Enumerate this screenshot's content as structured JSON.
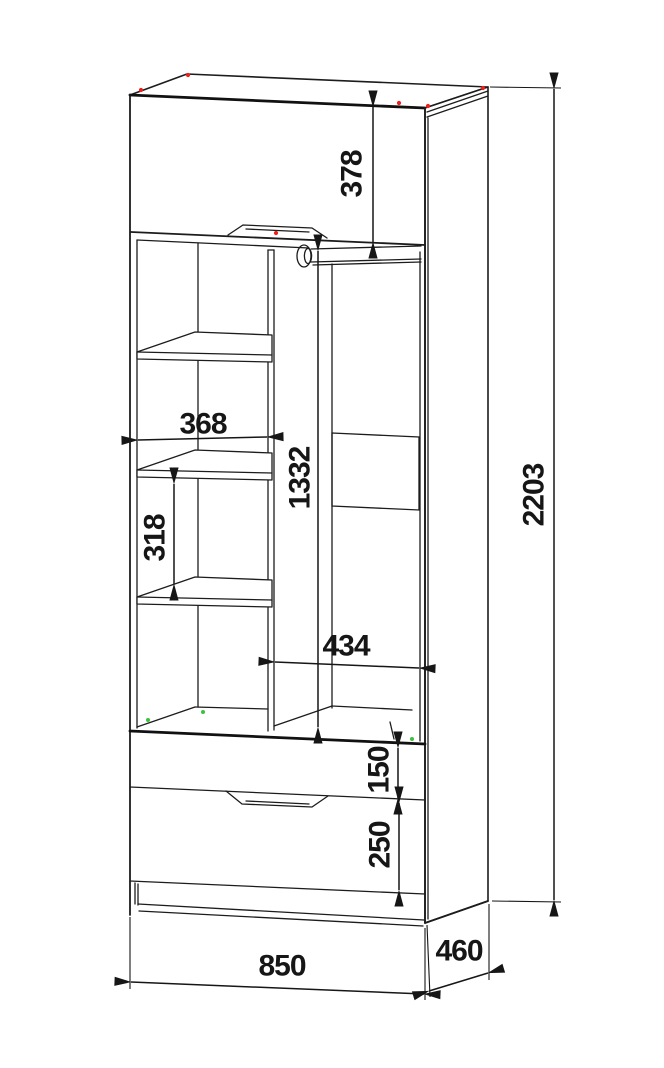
{
  "drawing": {
    "title": "wardrobe-technical-dimension-drawing",
    "colors": {
      "line": "#1c1c1c",
      "background": "#ffffff",
      "corner_marker": "#ee1f1f",
      "assembly_marker": "#3fbf3f"
    },
    "dimensions": {
      "flap_height": {
        "value": "378",
        "orientation": "vertical",
        "meaning": "top flap door front height"
      },
      "hang_height": {
        "value": "1332",
        "orientation": "vertical",
        "meaning": "hanging compartment interior height"
      },
      "shelf_width": {
        "value": "368",
        "orientation": "horizontal",
        "meaning": "left shelf compartment interior width"
      },
      "shelf_gap": {
        "value": "318",
        "orientation": "vertical",
        "meaning": "spacing between shelves"
      },
      "hang_width": {
        "value": "434",
        "orientation": "horizontal",
        "meaning": "hanging compartment interior width"
      },
      "drawer_top_height": {
        "value": "150",
        "orientation": "vertical",
        "meaning": "upper drawer front height"
      },
      "drawer_bottom_height": {
        "value": "250",
        "orientation": "vertical",
        "meaning": "lower drawer front height"
      },
      "overall_height": {
        "value": "2203",
        "orientation": "vertical",
        "meaning": "overall cabinet height"
      },
      "overall_width": {
        "value": "850",
        "orientation": "horizontal",
        "meaning": "overall cabinet width"
      },
      "overall_depth": {
        "value": "460",
        "orientation": "diagonal",
        "meaning": "overall cabinet depth"
      }
    }
  }
}
